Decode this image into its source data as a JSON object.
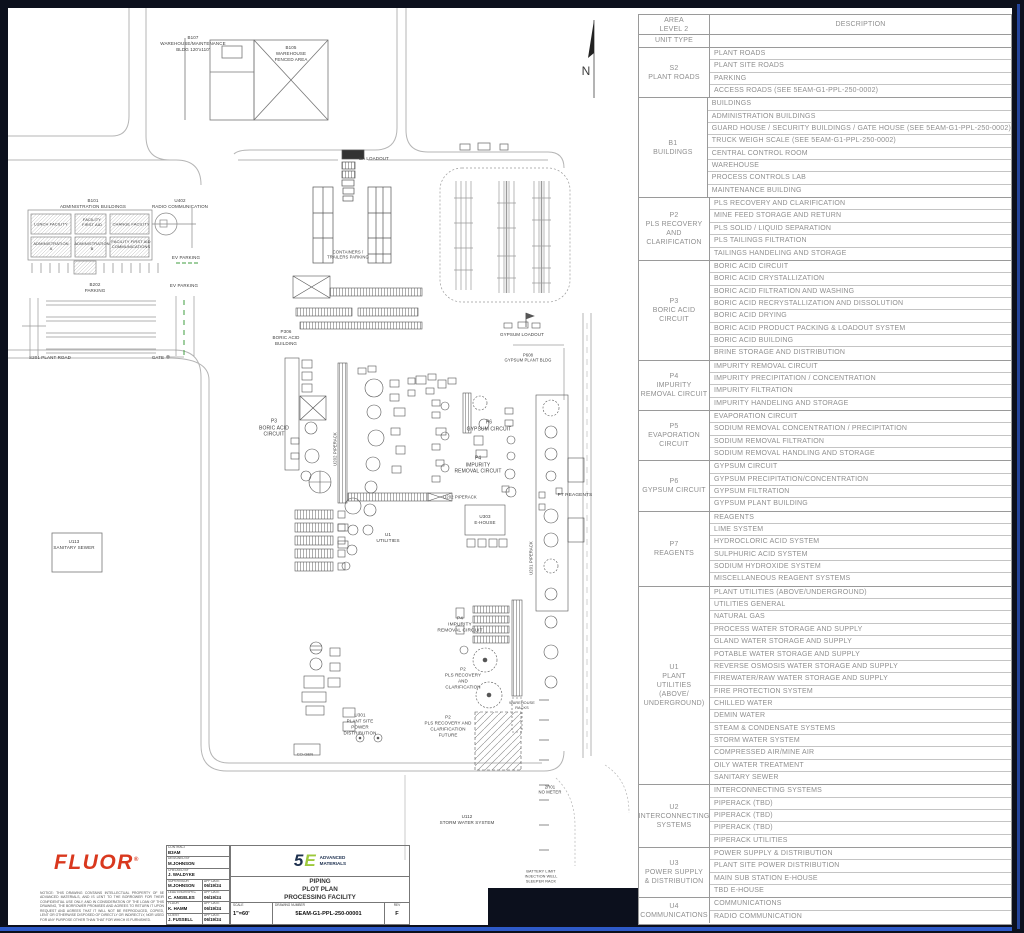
{
  "colors": {
    "background": "#0c101d",
    "accent_blue": "#2e5ac8",
    "fluor_red": "#d9381e",
    "brand_navy": "#1c2f4e",
    "brand_green": "#9dc93c",
    "ev_green": "#3f9e3f"
  },
  "table": {
    "header": {
      "col1": "AREA\nLEVEL 2",
      "col2": "DESCRIPTION",
      "unit_type": "UNIT TYPE"
    },
    "groups": [
      {
        "unit": "S2\nPLANT ROADS",
        "rows": [
          "PLANT ROADS",
          "PLANT SITE ROADS",
          "PARKING",
          "ACCESS ROADS (SEE 5EAM-G1-PPL-250-0002)"
        ]
      },
      {
        "unit": "B1\nBUILDINGS",
        "rows": [
          "BUILDINGS",
          "ADMINISTRATION BUILDINGS",
          "GUARD HOUSE / SECURITY BUILDINGS / GATE HOUSE (SEE 5EAM-G1-PPL-250-0002)",
          "TRUCK WEIGH SCALE (SEE 5EAM-G1-PPL-250-0002)",
          "CENTRAL CONTROL ROOM",
          "WAREHOUSE",
          "PROCESS CONTROLS LAB",
          "MAINTENANCE BUILDING"
        ]
      },
      {
        "unit": "P2\nPLS RECOVERY\nAND\nCLARIFICATION",
        "rows": [
          "PLS RECOVERY AND CLARIFICATION",
          "MINE FEED STORAGE AND RETURN",
          "PLS SOLID / LIQUID SEPARATION",
          "PLS TAILINGS FILTRATION",
          "TAILINGS HANDELING AND STORAGE"
        ]
      },
      {
        "unit": "P3\nBORIC ACID\nCIRCUIT",
        "rows": [
          "BORIC ACID CIRCUIT",
          "BORIC ACID CRYSTALLIZATION",
          "BORIC ACID FILTRATION AND WASHING",
          "BORIC ACID RECRYSTALLIZATION AND DISSOLUTION",
          "BORIC ACID DRYING",
          "BORIC ACID PRODUCT PACKING & LOADOUT SYSTEM",
          "BORIC ACID BUILDING",
          "BRINE STORAGE AND DISTRIBUTION"
        ]
      },
      {
        "unit": "P4\nIMPURITY\nREMOVAL CIRCUIT",
        "rows": [
          "IMPURITY REMOVAL CIRCUIT",
          "IMPURITY PRECIPITATION / CONCENTRATION",
          "IMPURITY FILTRATION",
          "IMPURITY HANDELING AND STORAGE"
        ]
      },
      {
        "unit": "P5\nEVAPORATION\nCIRCUIT",
        "rows": [
          "EVAPORATION CIRCUIT",
          "SODIUM REMOVAL CONCENTRATION / PRECIPITATION",
          "SODIUM REMOVAL FILTRATION",
          "SODIUM REMOVAL HANDLING AND STORAGE"
        ]
      },
      {
        "unit": "P6\nGYPSUM CIRCUIT",
        "rows": [
          "GYPSUM CIRCUIT",
          "GYPSUM PRECIPITATION/CONCENTRATION",
          "GYPSUM FILTRATION",
          "GYPSUM PLANT BUILDING"
        ]
      },
      {
        "unit": "P7\nREAGENTS",
        "rows": [
          "REAGENTS",
          "LIME SYSTEM",
          "HYDROCLORIC ACID SYSTEM",
          "SULPHURIC ACID SYSTEM",
          "SODIUM HYDROXIDE SYSTEM",
          "MISCELLANEOUS REAGENT SYSTEMS"
        ]
      },
      {
        "unit": "U1\nPLANT\nUTILITIES\n(ABOVE/\nUNDERGROUND)",
        "rows": [
          "PLANT UTILITIES (ABOVE/UNDERGROUND)",
          "UTILITIES GENERAL",
          "NATURAL GAS",
          "PROCESS WATER STORAGE AND SUPPLY",
          "GLAND WATER STORAGE AND SUPPLY",
          "POTABLE WATER STORAGE AND SUPPLY",
          "REVERSE OSMOSIS WATER STORAGE AND SUPPLY",
          "FIREWATER/RAW WATER STORAGE AND SUPPLY",
          "FIRE PROTECTION SYSTEM",
          "CHILLED WATER",
          "DEMIN WATER",
          "STEAM & CONDENSATE SYSTEMS",
          "STORM WATER SYSTEM",
          "COMPRESSED AIR/MINE AIR",
          "OILY WATER TREATMENT",
          "SANITARY SEWER"
        ]
      },
      {
        "unit": "U2\nINTERCONNECTING\nSYSTEMS",
        "rows": [
          "INTERCONNECTING SYSTEMS",
          "PIPERACK (TBD)",
          "PIPERACK (TBD)",
          "PIPERACK  (TBD)",
          "PIPERACK UTILITIES"
        ]
      },
      {
        "unit": "U3\nPOWER SUPPLY\n& DISTRIBUTION",
        "rows": [
          "POWER SUPPLY & DISTRIBUTION",
          "PLANT SITE POWER DISTRIBUTION",
          "MAIN SUB STATION E-HOUSE",
          "TBD E-HOUSE"
        ]
      },
      {
        "unit": "U4\nCOMMUNICATIONS",
        "rows": [
          "COMMUNICATIONS",
          "RADIO COMMUNICATION"
        ]
      }
    ]
  },
  "plan": {
    "labels": [
      {
        "id": "b107",
        "x": 185,
        "y": 36,
        "size": 4.5,
        "text": "B107\nWAREHOUSE/MAINTENANCE\nBLDG 120'x110'"
      },
      {
        "id": "b105",
        "x": 283,
        "y": 46,
        "size": 4.5,
        "text": "B105\nWAREHOUSE\nFENCED AREA"
      },
      {
        "id": "b101",
        "x": 85,
        "y": 196,
        "size": 4.5,
        "text": "B101\nADMINISTRATION BUILDINGS"
      },
      {
        "id": "lunch-facility",
        "x": 43,
        "y": 216,
        "size": 4,
        "text": "LUNCH FACILITY"
      },
      {
        "id": "facility-first-aid",
        "x": 84,
        "y": 214,
        "size": 4,
        "text": "FACILITY\nFIRST AID"
      },
      {
        "id": "change-facility",
        "x": 123,
        "y": 216,
        "size": 4,
        "text": "CHANGE FACILITY"
      },
      {
        "id": "administration-a",
        "x": 43,
        "y": 238,
        "size": 4,
        "text": "ADMINISTRATION\nA"
      },
      {
        "id": "administration-b",
        "x": 84,
        "y": 238,
        "size": 4,
        "text": "ADMINISTRATION\nB"
      },
      {
        "id": "facility-communications",
        "x": 123,
        "y": 236,
        "size": 4,
        "text": "FACILITY FIRST AID\nCOMMUNICATIONS"
      },
      {
        "id": "u402",
        "x": 172,
        "y": 196,
        "size": 4.5,
        "text": "U402\nRADIO COMMUNICATION"
      },
      {
        "id": "ev-parking-1",
        "x": 178,
        "y": 250,
        "size": 4.5,
        "text": "EV PARKING"
      },
      {
        "id": "ev-parking-2",
        "x": 176,
        "y": 278,
        "size": 4.5,
        "text": "EV PARKING"
      },
      {
        "id": "b202-parking",
        "x": 87,
        "y": 280,
        "size": 4.5,
        "text": "B202\nPARKING"
      },
      {
        "id": "s201-plant-road",
        "x": 42,
        "y": 350,
        "size": 4.5,
        "text": "S201 PLANT ROAD"
      },
      {
        "id": "gate",
        "x": 150,
        "y": 350,
        "size": 4.5,
        "text": "GATE"
      },
      {
        "id": "u113-sanitary",
        "x": 66,
        "y": 537,
        "size": 4.5,
        "text": "U113\nSANITARY SEWER"
      },
      {
        "id": "ba-loadout",
        "x": 366,
        "y": 151,
        "size": 4.5,
        "text": "BA LOADOUT"
      },
      {
        "id": "containers",
        "x": 340,
        "y": 247,
        "size": 4.2,
        "text": "CONTAINERS /\nTRAILERS PARKING"
      },
      {
        "id": "p306-boric-bldg",
        "x": 278,
        "y": 330,
        "size": 4.5,
        "text": "P306\nBORIC ACID\nBUILDING"
      },
      {
        "id": "p3-circuit",
        "x": 266,
        "y": 420,
        "size": 5,
        "text": "P3\nBORIC ACID\nCIRCUIT"
      },
      {
        "id": "u202-piperack-v",
        "x": 327,
        "y": 441,
        "size": 4.2,
        "rot": -90,
        "text": "U202 PIPERACK"
      },
      {
        "id": "u202-piperack-h",
        "x": 452,
        "y": 489,
        "size": 4.2,
        "text": "U202 PIPERACK"
      },
      {
        "id": "u1-utilities",
        "x": 380,
        "y": 531,
        "size": 4.8,
        "text": "U1\nUTILITIES"
      },
      {
        "id": "u303-ehouse",
        "x": 477,
        "y": 512,
        "size": 4.5,
        "text": "U303\nE-HOUSE"
      },
      {
        "id": "p6-gypsum",
        "x": 481,
        "y": 418,
        "size": 5,
        "text": "P6\nGYPSUM CIRCUIT"
      },
      {
        "id": "p4-impurity-upper",
        "x": 470,
        "y": 457,
        "size": 5,
        "text": "P4\nIMPURITY\nREMOVAL CIRCUIT"
      },
      {
        "id": "p7-reagents",
        "x": 567,
        "y": 488,
        "size": 4.8,
        "text": "P7 REAGENTS"
      },
      {
        "id": "u201-piperack-v",
        "x": 523,
        "y": 550,
        "size": 4.2,
        "rot": -90,
        "text": "U201 PIPERACK"
      },
      {
        "id": "p4-impurity-lower",
        "x": 452,
        "y": 618,
        "size": 4.8,
        "text": "P4\nIMPURITY\nREMOVAL CIRCUIT"
      },
      {
        "id": "p2-pls",
        "x": 455,
        "y": 670,
        "size": 4.5,
        "text": "P2\nPLS RECOVERY\nAND\nCLARIFICATION"
      },
      {
        "id": "p2-future",
        "x": 440,
        "y": 718,
        "size": 4.5,
        "text": "P2\nPLS RECOVERY AND\nCLARIFICATION\nFUTURE"
      },
      {
        "id": "warehouse-racks",
        "x": 514,
        "y": 698,
        "size": 3.8,
        "text": "WAREHOUSE\nRACKS"
      },
      {
        "id": "u301-power",
        "x": 352,
        "y": 716,
        "size": 4.5,
        "text": "U301\nPLANT SITE\nPOWER\nDISTRIBUTION"
      },
      {
        "id": "co-gen",
        "x": 297,
        "y": 746,
        "size": 4,
        "text": "CO-GEN"
      },
      {
        "id": "gypsum-loadout",
        "x": 514,
        "y": 327,
        "size": 4.5,
        "text": "GYPSUM LOADOUT"
      },
      {
        "id": "p608-gypsum-bldg",
        "x": 520,
        "y": 350,
        "size": 4.2,
        "text": "P608\nGYPSUM PLANT BLDG"
      },
      {
        "id": "u112-storm",
        "x": 459,
        "y": 812,
        "size": 4.5,
        "text": "U112\nSTORM WATER SYSTEM"
      },
      {
        "id": "no-meter",
        "x": 542,
        "y": 782,
        "size": 4.2,
        "text": "2R01\nNO METER"
      },
      {
        "id": "battery-limit",
        "x": 533,
        "y": 869,
        "size": 3.8,
        "text": "BATTERY LIMIT\nINJECTION WELL\nSLEEPER RACK"
      },
      {
        "id": "north-letter",
        "x": 578,
        "y": 64,
        "size": 12,
        "text": "N"
      }
    ]
  },
  "title_block": {
    "fluor_logo": "FLUOR",
    "fluor_reg": "®",
    "notice": "NOTICE: THIS DRAWING CONTAINS INTELLECTUAL PROPERTY OF 5E ADVANCED MATERIALS, AND IS LENT TO THE BORROWER FOR THEIR CONFIDENTIAL USE ONLY, AND IN CONSIDERATION OF THE LOAN OF THIS DRAWING, THE BORROWER PROMISES AND AGREES TO RETURN IT UPON REQUEST AND AGREES THAT IT WILL NOT BE REPRODUCED, COPIED, LENT OR OTHERWISE DISPOSED OF DIRECTLY OR INDIRECTLY, NOR USED FOR ANY PURPOSE OTHER THAN THAT FOR WHICH IS FURNISHED.",
    "personnel": [
      {
        "label": "CONTRACT",
        "value": "B3AM"
      },
      {
        "label": "DESIGNED BY",
        "value": "M.JOHNSON"
      },
      {
        "label": "CHECKED BY",
        "value": "J. WALDYKE"
      },
      {
        "label": "SUPERVISOR",
        "value": "M.JOHNSON",
        "date_label": "APP DATE",
        "date": "06/19/24"
      },
      {
        "label": "LEAD ENGR/SPEC",
        "value": "C. ANGELES",
        "date_label": "APP DATE",
        "date": "06/19/24"
      },
      {
        "label": "FLUOR",
        "value": "K. HAMM",
        "date_label": "APP DATE",
        "date": "06/19/24"
      },
      {
        "label": "CLIENT",
        "value": "J. FUSSELL",
        "date_label": "APP DATE",
        "date": "06/19/24"
      }
    ],
    "brand": {
      "five": "5",
      "e": "E",
      "name": "ADVANCED\nMATERIALS"
    },
    "title": "PIPING\nPLOT PLAN\nPROCESSING FACILITY",
    "scale_label": "SCALE",
    "scale": "1\"=60'",
    "dwg_label": "DRAWING NUMBER",
    "dwg": "5EAM-G1-PPL-250-00001",
    "rev_label": "REV",
    "rev": "F"
  }
}
